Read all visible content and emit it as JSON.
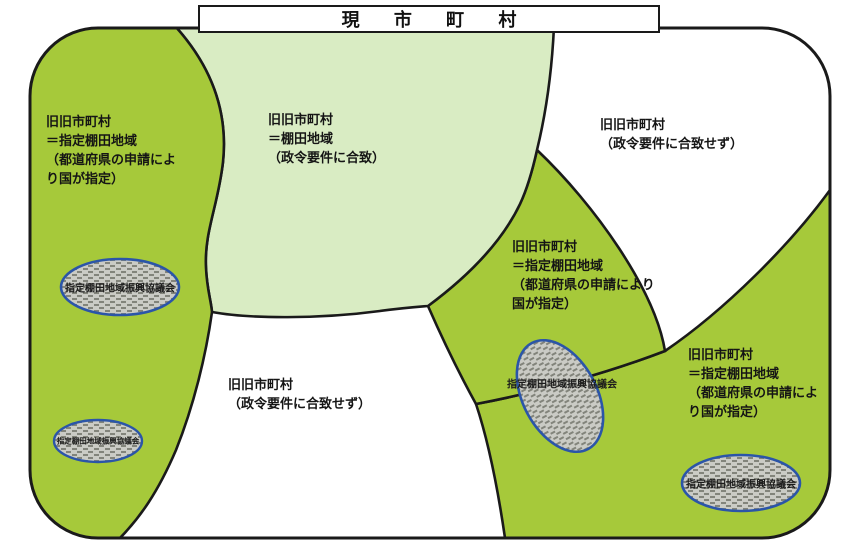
{
  "title": "現 市 町 村",
  "regions": {
    "left": {
      "lines": [
        "旧旧市町村",
        "＝指定棚田地域",
        "（都道府県の申請によ",
        "り国が指定）"
      ]
    },
    "center": {
      "lines": [
        "旧旧市町村",
        "＝棚田地域",
        "（政令要件に合致）"
      ]
    },
    "top_right": {
      "lines": [
        "旧旧市町村",
        "（政令要件に合致せず）"
      ]
    },
    "mid": {
      "lines": [
        "旧旧市町村",
        "＝指定棚田地域",
        "（都道府県の申請により",
        "国が指定）"
      ]
    },
    "bottom_center": {
      "lines": [
        "旧旧市町村",
        "（政令要件に合致せず）"
      ]
    },
    "bottom_right": {
      "lines": [
        "旧旧市町村",
        "＝指定棚田地域",
        "（都道府県の申請によ",
        "り国が指定）"
      ]
    }
  },
  "council": {
    "label": "指定棚田地域振興協議会"
  },
  "colors": {
    "bright_green": "#a6c93a",
    "light_green": "#d9ecc3",
    "white": "#ffffff",
    "line": "#1a1a1a",
    "ellipse_bg": "#cacbc5",
    "ellipse_dash": "#82847b",
    "ellipse_border": "#2b55a8"
  }
}
